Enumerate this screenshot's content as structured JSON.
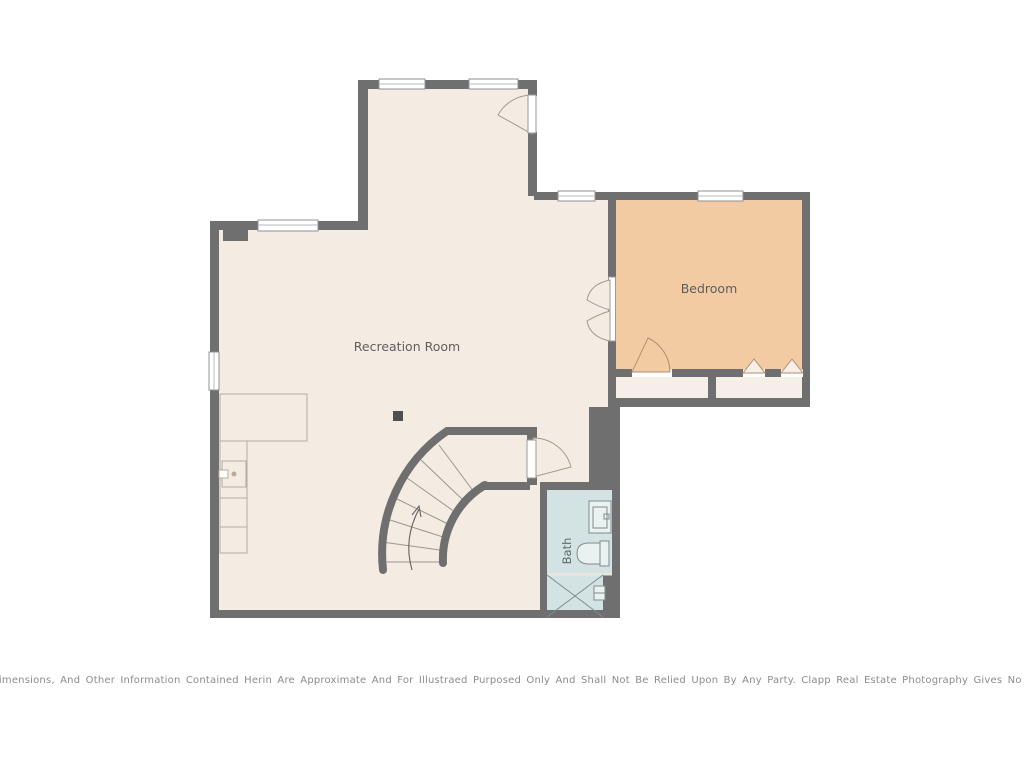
{
  "plan": {
    "labels": {
      "recreation_room": "Recreation Room",
      "bedroom": "Bedroom",
      "bath": "Bath"
    },
    "disclaimer": "Dimensions, And Other Information Contained Herin Are Approximate And For Illustraed Purposed Only And Shall Not Be Relied Upon By Any Party. Clapp Real Estate Photography Gives No Guarantee, Warranty Or Representation As To The Accuracy Of This",
    "colors": {
      "wall": "#6f6f6f",
      "floor": "#f4ece3",
      "bedroom_floor": "#f2cba3",
      "bath_floor": "#d3e3e3",
      "background": "#ffffff"
    },
    "features": [
      "curved-staircase",
      "kitchen-counter",
      "support-post",
      "bath-sink",
      "toilet",
      "shower",
      "closets"
    ]
  }
}
